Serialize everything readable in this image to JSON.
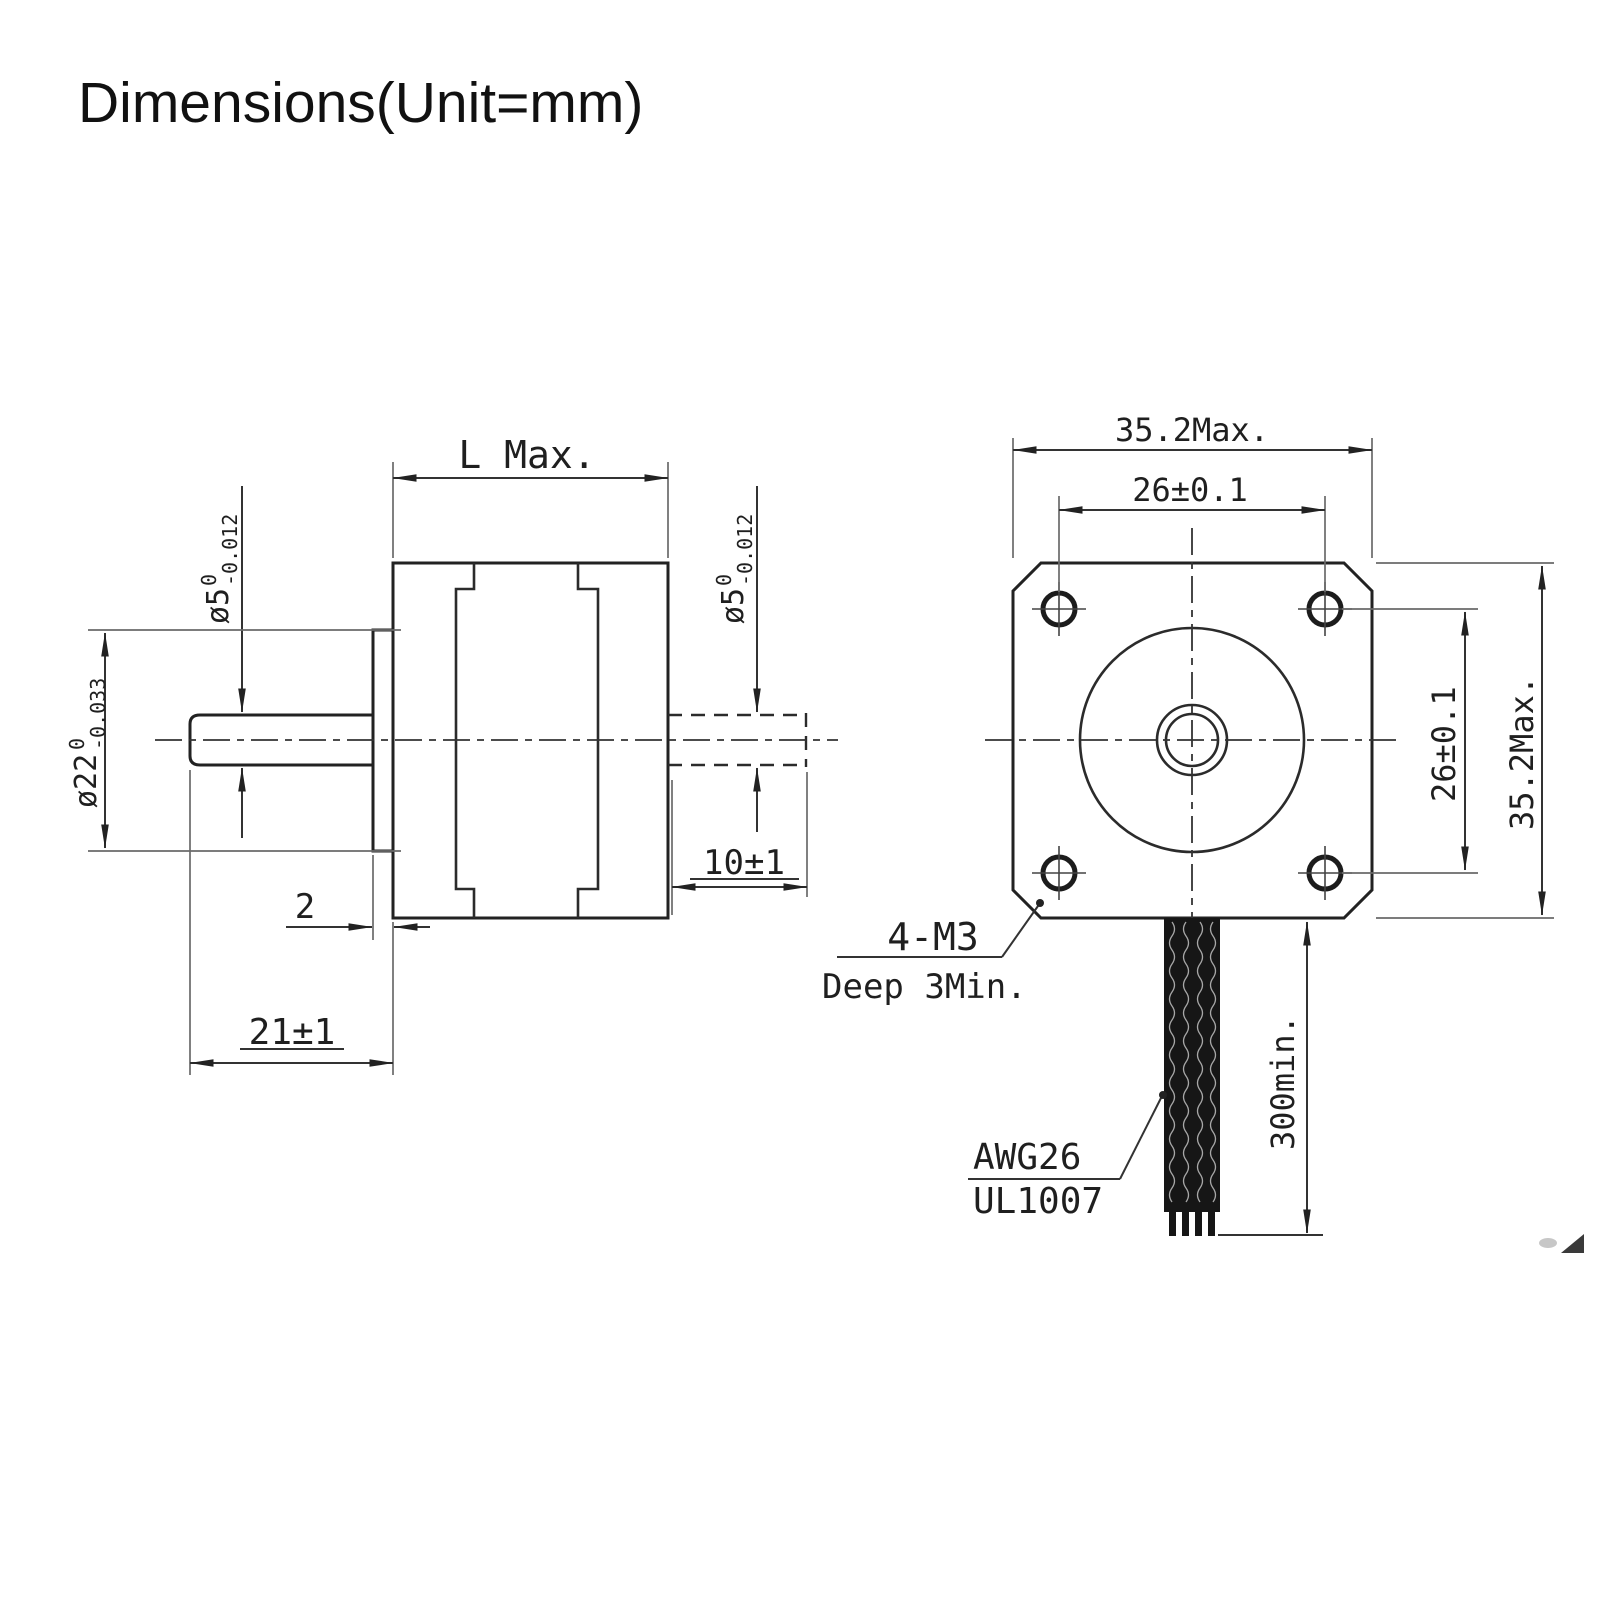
{
  "title": "Dimensions(Unit=mm)",
  "side_view": {
    "length_dim": "L Max.",
    "front_shaft_dia": {
      "prefix": "ø5",
      "upper": "0",
      "lower": "-0.012"
    },
    "rear_shaft_dia": {
      "prefix": "ø5",
      "upper": "0",
      "lower": "-0.012"
    },
    "pilot_dia": {
      "prefix": "ø22",
      "upper": "0",
      "lower": "-0.033"
    },
    "pilot_depth": "2",
    "front_shaft_length": "21±1",
    "rear_shaft_length": "10±1"
  },
  "front_view": {
    "width_max": "35.2Max.",
    "hole_spacing_horizontal": "26±0.1",
    "hole_spacing_vertical": "26±0.1",
    "height_max": "35.2Max.",
    "mounting_holes_note": {
      "line1": "4-M3",
      "line2": "Deep 3Min."
    },
    "cable_note": {
      "line1": "AWG26",
      "line2": "UL1007"
    },
    "cable_length": "300min."
  }
}
